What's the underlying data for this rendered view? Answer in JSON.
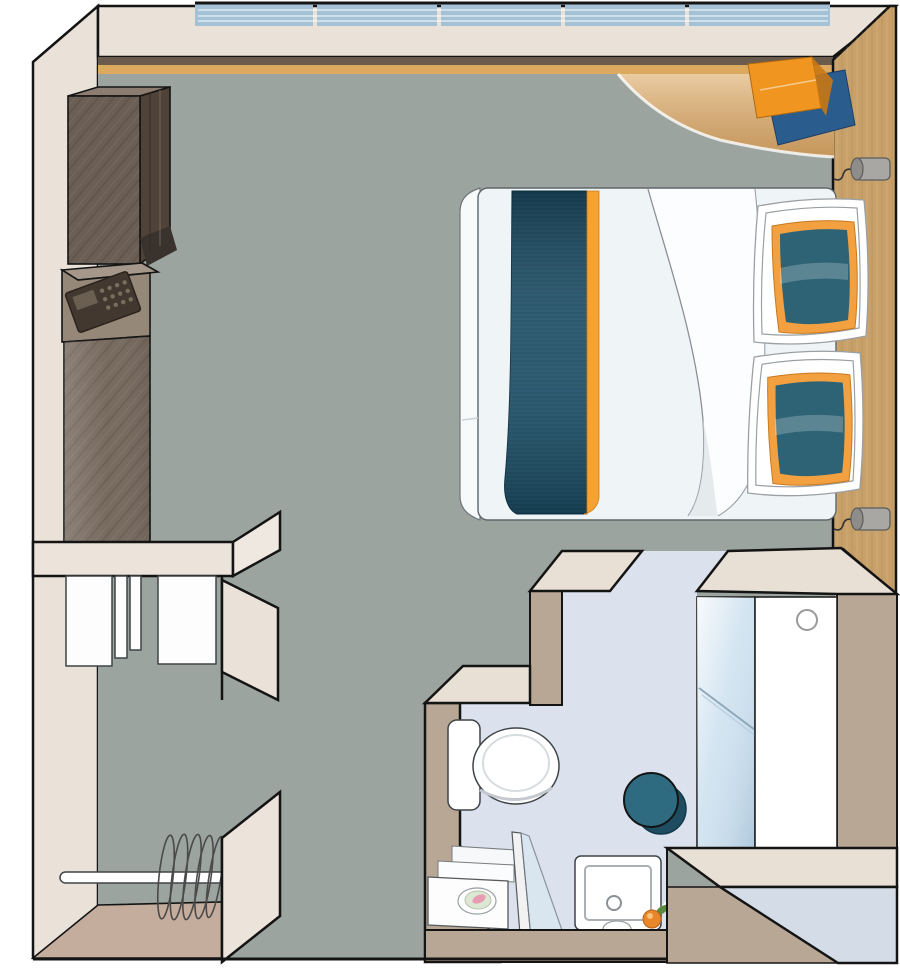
{
  "meta": {
    "title": "cabin-floor-plan",
    "view": "top-down axonometric illustration",
    "rooms": [
      "bedroom",
      "bathroom",
      "entry-closet-area"
    ]
  },
  "inventory": {
    "window_pane_count": 5,
    "reading_lamp_count": 2,
    "pillow_count": 2,
    "hanger_count": 5,
    "bedroom_fixtures": [
      "panoramic-window",
      "corner-desk",
      "desk-towels",
      "double-bed",
      "bed-runner",
      "pillows",
      "tv-cabinet",
      "safe",
      "wardrobe-panel",
      "reading-lamps"
    ],
    "bathroom_fixtures": [
      "toilet",
      "vanity-towels",
      "soap-dish",
      "shower-screen",
      "shower-tray",
      "stool",
      "glass-panel",
      "bathroom-door",
      "flower"
    ],
    "entry_fixtures": [
      "closet-shelves",
      "clothes-rod",
      "hangers",
      "entrance-door"
    ]
  },
  "colors": {
    "page_bg": "#ffffff",
    "wall": "#eae2d9",
    "wall_slab": "#e8dfd5",
    "floor": "#9ba49e",
    "window_glass": "#a3c2d6",
    "sill_dark": "#6b5b4d",
    "sill_wood": "#dda95f",
    "cabinet_front": "#6b5e54",
    "cabinet_side": "#4f4238",
    "cabinet_top": "#8d7d70",
    "safe_body": "#968879",
    "keypad": "#42382f",
    "wardrobe_front": "#776a5f",
    "closet_panel": "#ece3da",
    "shelf_white": "#fdfdfd",
    "closet_floor": "#c4ad9d",
    "wood_wall": "#c8a069",
    "desk_wood": "#dfb071",
    "towel_orange": "#f0951f",
    "towel_blue": "#2b5c8e",
    "bed_white": "#eff5f7",
    "bed_fold": "#fcfdfe",
    "runner_teal": "#1d5068",
    "runner_orange": "#f4a232",
    "pillow_white": "#ffffff",
    "pillow_teal": "#2d6375",
    "pillow_orange": "#f2a040",
    "lamp_gray": "#a9a7a3",
    "bath_floor": "#dbe2ed",
    "bath_wall": "#b9a795",
    "glass_panel": "#cfe2f0",
    "door_white": "#ffffff",
    "stool_teal": "#2e6b80",
    "stool_shadow": "#1e4d61",
    "entry_door": "#d4dde7",
    "toilet_white": "#ffffff",
    "soap_pink": "#e89cb2",
    "soap_dish_green": "#dde8d4",
    "flower_orange": "#e8862a",
    "flower_green": "#5a8a3c"
  }
}
